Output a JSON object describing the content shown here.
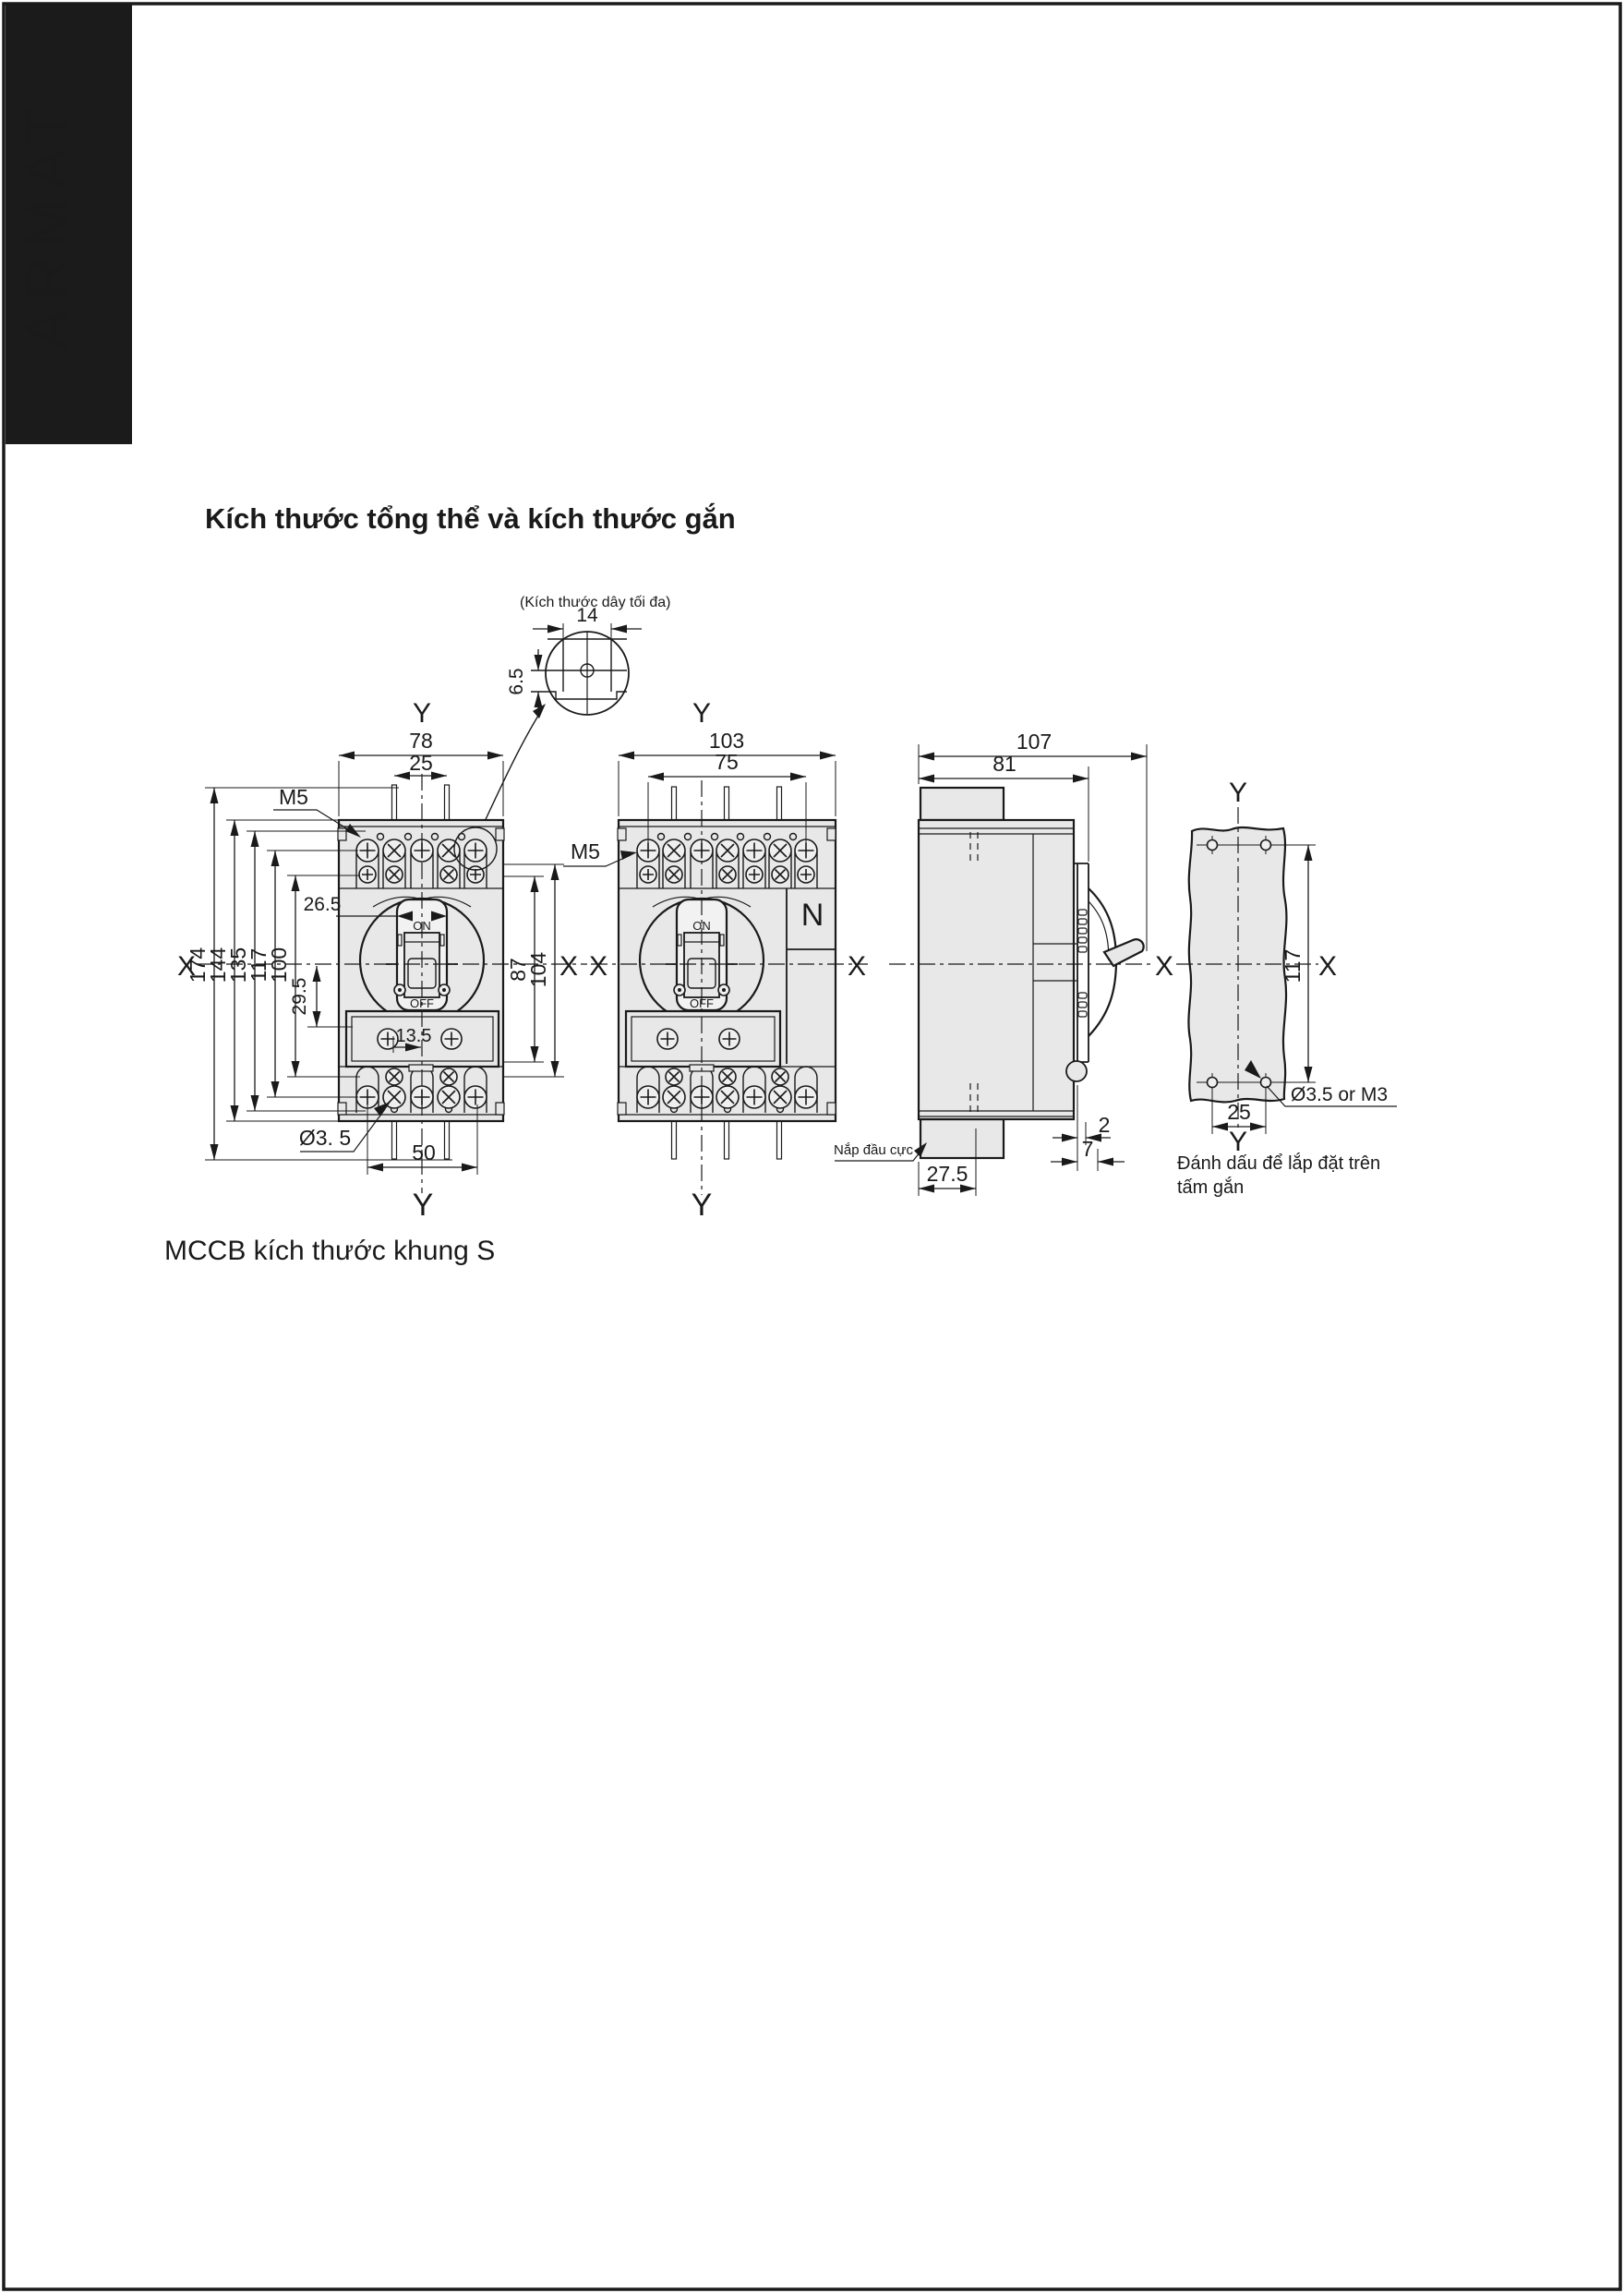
{
  "page": {
    "brand": "ARMAT",
    "title": "Kích thước tổng thể và kích thước gắn",
    "caption": "MCCB kích thước khung S"
  },
  "axes": {
    "x": "X",
    "y": "Y"
  },
  "wire_detail": {
    "note": "(Kích thước dây tối đa)",
    "width": "14",
    "height": "6.5"
  },
  "front3p": {
    "overall_width": "78",
    "wire_pitch": "25",
    "screw": "M5",
    "window_width": "26.5",
    "overall_height": "174",
    "body_height": "144",
    "cover_span": "135",
    "terminal_span": "117",
    "inner_span": "100",
    "center_to_cover": "29.5",
    "right_inner": "87",
    "right_outer": "104",
    "cover_offset": "13.5",
    "mount_hole": "Ø3. 5",
    "mount_pitch": "50",
    "on": "ON",
    "off": "OFF"
  },
  "front4p": {
    "overall_width": "103",
    "pole_span": "75",
    "screw": "M5",
    "neutral": "N",
    "on": "ON",
    "off": "OFF"
  },
  "side": {
    "overall_depth": "107",
    "body_depth": "81",
    "gap": "2",
    "step": "7",
    "cover_depth": "27.5",
    "terminal_cover": "Nắp đầu cực"
  },
  "plate": {
    "hole_span": "117",
    "hole_pitch": "25",
    "hole_spec": "Ø3.5 or M3",
    "caption1": "Đánh dấu để lắp đặt trên",
    "caption2": "tấm gắn"
  }
}
